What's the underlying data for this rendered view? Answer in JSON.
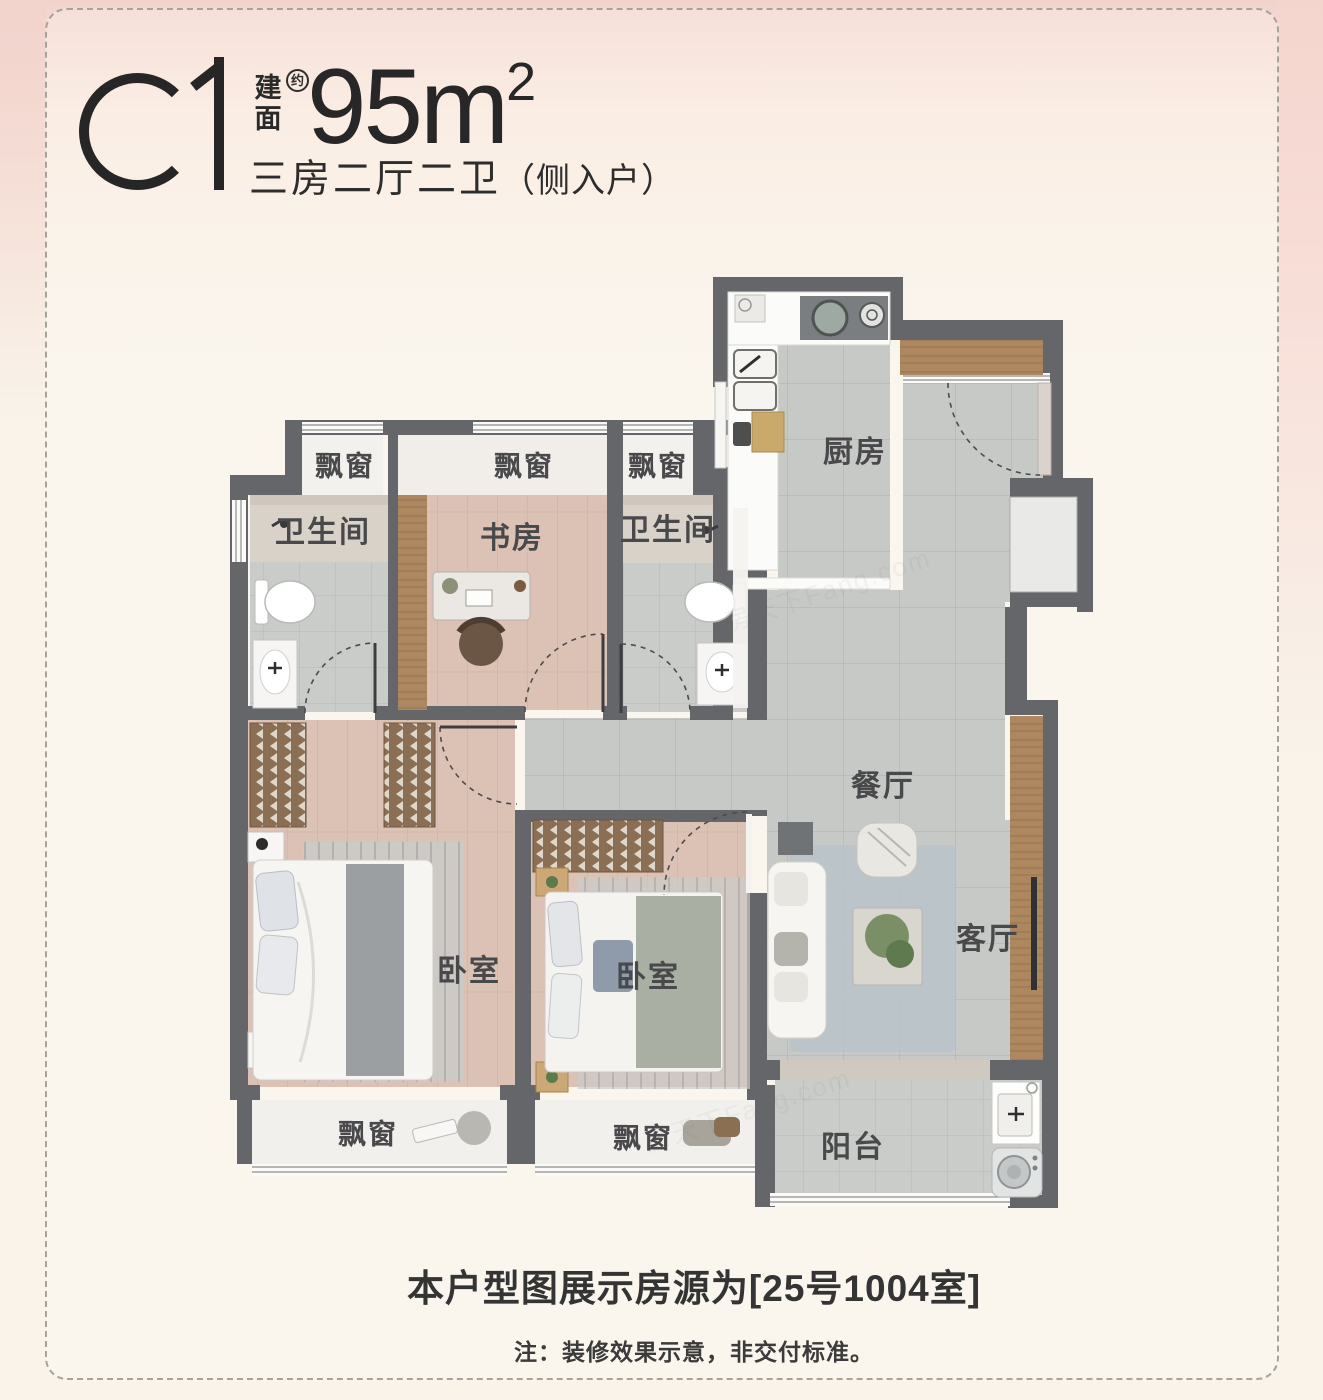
{
  "header": {
    "unit_code": "C1",
    "area_char_top": "建",
    "area_char_bottom": "面",
    "area_approx": "约",
    "area_value": "95m",
    "area_exponent": "2",
    "subtitle": "三房二厅二卫",
    "subtitle_paren": "（侧入户）"
  },
  "rooms": {
    "bay_window": "飘窗",
    "bathroom": "卫生间",
    "study": "书房",
    "kitchen": "厨房",
    "dining": "餐厅",
    "bedroom": "卧室",
    "living": "客厅",
    "balcony": "阳台"
  },
  "footer": {
    "listing_note": "本户型图展示房源为[25号1004室]",
    "disclaimer": "注：装修效果示意，非交付标准。"
  },
  "watermark": "房天下Fang.com",
  "colors": {
    "wall": "#646669",
    "tile_floor": "#c7c9c6",
    "wood_floor": "#dcc2b5",
    "accent_pink_bg": "#f1d3cc",
    "cream_bg": "#f9f3ea"
  }
}
